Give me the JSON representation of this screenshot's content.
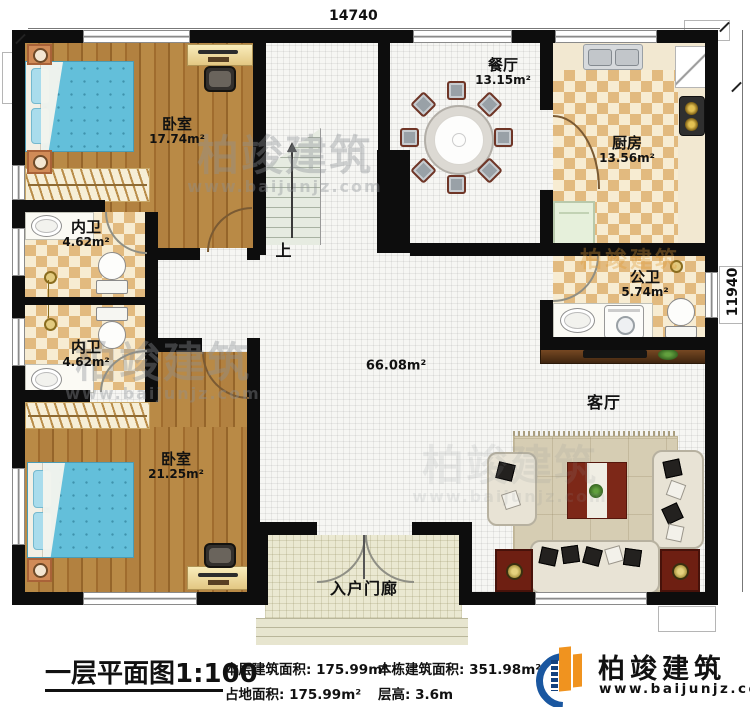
{
  "plan": {
    "dim_top": "14740",
    "dim_right": "11940",
    "stairs_label": "上",
    "hall_area": "66.08m²",
    "rooms": {
      "bedroom1": {
        "name": "卧室",
        "area": "17.74m²"
      },
      "bath1": {
        "name": "内卫",
        "area": "4.62m²"
      },
      "bath2": {
        "name": "内卫",
        "area": "4.62m²"
      },
      "bedroom2": {
        "name": "卧室",
        "area": "21.25m²"
      },
      "dining": {
        "name": "餐厅",
        "area": "13.15m²"
      },
      "kitchen": {
        "name": "厨房",
        "area": "13.56m²"
      },
      "publicbath": {
        "name": "公卫",
        "area": "5.74m²"
      },
      "living": {
        "name": "客厅"
      },
      "porch": {
        "name": "入户门廊"
      }
    }
  },
  "watermark": {
    "brand": "柏竣建筑",
    "url": "www.baijunjz.com"
  },
  "title_block": {
    "title": "一层平面图1:100",
    "stats": [
      {
        "label": "本层建筑面积:",
        "value": "175.99m²"
      },
      {
        "label": "本栋建筑面积:",
        "value": "351.98m²"
      },
      {
        "label": "占地面积:",
        "value": "175.99m²"
      },
      {
        "label": "层高:",
        "value": "3.6m"
      }
    ]
  },
  "logo": {
    "brand": "柏竣建筑",
    "url": "www.baijunjz.com"
  },
  "palette": {
    "wall": "#0d0d0d",
    "wood": "#b0803e",
    "tile": "#e2ba7f",
    "bed": "#63bfda",
    "brand_blue": "#1a57a0",
    "brand_orange": "#f0931f"
  }
}
